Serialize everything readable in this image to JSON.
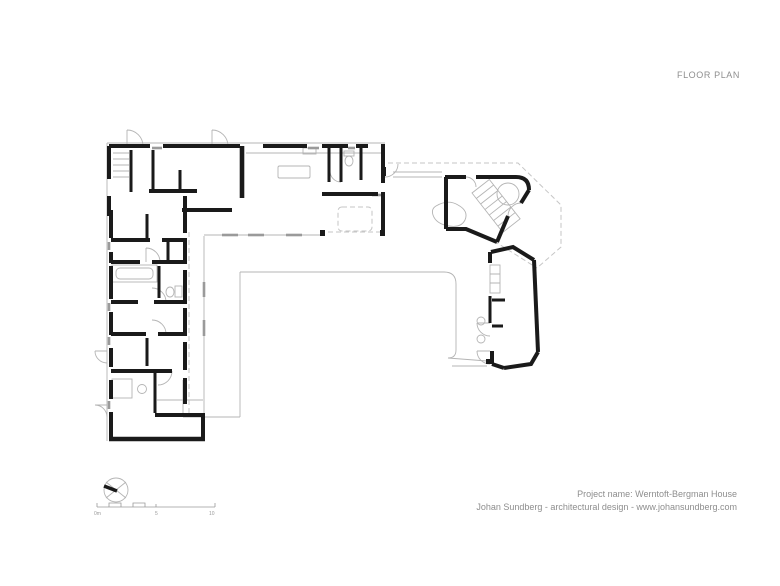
{
  "sheet": {
    "title": "FLOOR PLAN"
  },
  "footer": {
    "project": "Project name: Werntoft-Bergman House",
    "credit": "Johan Sundberg - architectural design - www.johansundberg.com"
  },
  "scale_bar": {
    "labels": [
      "0m",
      "5",
      "10"
    ]
  },
  "icons": {
    "compass": "north-arrow-icon"
  },
  "colors": {
    "wall": "#1a1a1a",
    "thin": "#b4b4b4",
    "dashed": "#c6c6c6",
    "sill": "#9a9a9a",
    "text": "#8e8e8e",
    "background": "#ffffff"
  }
}
